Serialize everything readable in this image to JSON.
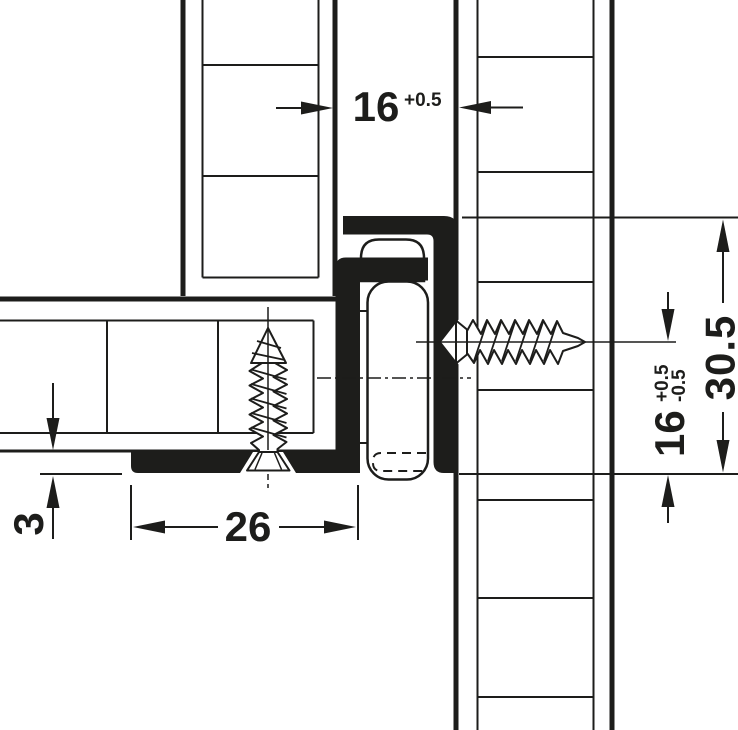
{
  "drawing": {
    "type": "technical-cross-section",
    "subject": "drawer runner mounting detail",
    "colors": {
      "ink": "#1d1d1b",
      "background": "#ffffff"
    },
    "dims": {
      "gap": {
        "value": "16",
        "tol_plus": "+0.5"
      },
      "height": {
        "value": "30.5"
      },
      "screw": {
        "value": "16",
        "tol_plus": "+0.5",
        "tol_minus": "-0.5"
      },
      "foot": {
        "value": "26"
      },
      "clearance": {
        "value": "3"
      }
    }
  }
}
